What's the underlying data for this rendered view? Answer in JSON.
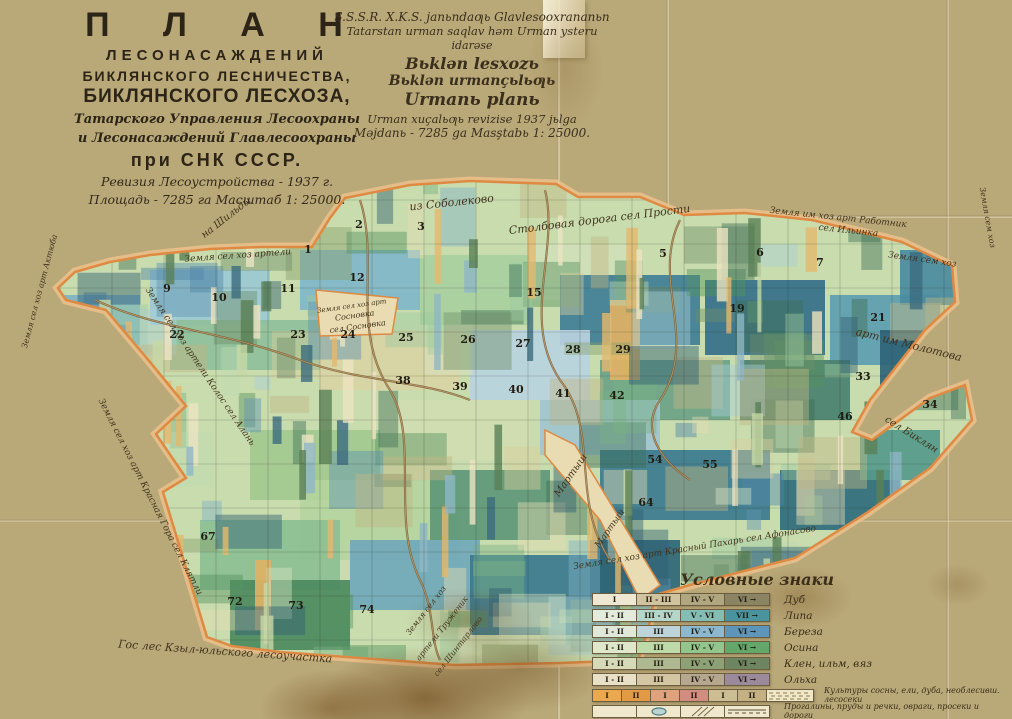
{
  "title_block": {
    "lines": [
      "П Л А Н",
      "ЛЕСОНАСАЖДЕНИЙ",
      "БИКЛЯНСКОГО  ЛЕСНИЧЕСТВА,",
      "БИКЛЯНСКОГО ЛЕСХОЗА,",
      "Татарского Управления Лесоохраны",
      "и Лесонасаждений Главлесоохраны",
      "при  СНК  СССР.",
      "Ревизия Лесоустройства - 1937 г.",
      "Площадь - 7285 га  Масштаб 1: 25000."
    ]
  },
  "tatar_block": {
    "lines": [
      "S.S.S.R. X.K.S. janьndaƣь Glavlesooxrananьn",
      "Tatarstan urman saqlav həm Urman ysteru",
      "idarəse",
      "Bьklən lesxozь",
      "Bьklən urmançьlьƣь",
      "Urmanь planь",
      "Urman xuçalьƣь revizise 1937 jьlga",
      "Məjdanь - 7285 ga  Masştabь 1: 25000."
    ]
  },
  "legend": {
    "title": "Условные знаки",
    "rows": [
      {
        "label": "Дуб",
        "cells": [
          {
            "t": "I",
            "c": "#eee7d2"
          },
          {
            "t": "II - III",
            "c": "#cfc49f"
          },
          {
            "t": "IV - V",
            "c": "#b0a67f"
          },
          {
            "t": "VI →",
            "c": "#8b8462"
          }
        ]
      },
      {
        "label": "Липа",
        "cells": [
          {
            "t": "I - II",
            "c": "#e3ecdc"
          },
          {
            "t": "III - IV",
            "c": "#b5d6ca"
          },
          {
            "t": "V - VI",
            "c": "#83bdb4"
          },
          {
            "t": "VII →",
            "c": "#49949e"
          }
        ]
      },
      {
        "label": "Береза",
        "cells": [
          {
            "t": "I - II",
            "c": "#e0e8da"
          },
          {
            "t": "III",
            "c": "#bcd4da"
          },
          {
            "t": "IV - V",
            "c": "#8cb9cf"
          },
          {
            "t": "VI →",
            "c": "#5d95bb"
          }
        ]
      },
      {
        "label": "Осина",
        "cells": [
          {
            "t": "I - II",
            "c": "#dfe8ca"
          },
          {
            "t": "III",
            "c": "#bedaa8"
          },
          {
            "t": "IV - V",
            "c": "#93c68c"
          },
          {
            "t": "VI →",
            "c": "#63a76b"
          }
        ]
      },
      {
        "label": "Клен, ильм, вяз",
        "cells": [
          {
            "t": "I - II",
            "c": "#d6dab9"
          },
          {
            "t": "III",
            "c": "#aeb991"
          },
          {
            "t": "IV - V",
            "c": "#8da177"
          },
          {
            "t": "VI →",
            "c": "#6d8561"
          }
        ]
      },
      {
        "label": "Ольха",
        "cells": [
          {
            "t": "I - II",
            "c": "#e9e0c8"
          },
          {
            "t": "III",
            "c": "#d4c6a3"
          },
          {
            "t": "IV - V",
            "c": "#b6a890"
          },
          {
            "t": "VI →",
            "c": "#9a8a9b"
          }
        ]
      }
    ],
    "row7": {
      "cells": [
        {
          "t": "I",
          "c": "#eaa94e"
        },
        {
          "t": "II",
          "c": "#e39a45"
        },
        {
          "t": "I",
          "c": "#dfa27c"
        },
        {
          "t": "II",
          "c": "#d28d80"
        },
        {
          "t": "I",
          "c": "#cdbd92"
        },
        {
          "t": "II",
          "c": "#c3b184"
        }
      ],
      "dashed_color": "#efe7c6",
      "label": "Культуры сосны, ели, дуба, необлесивш. лесосеки"
    },
    "row8": {
      "symbols": [
        "blank",
        "pond",
        "ravine",
        "road"
      ],
      "label": "Прогалины, пруды и речки, овраги, просеки и дороги"
    }
  },
  "map": {
    "paper": "#e9dcb2",
    "border_outer": "#f0c28c",
    "border_inner": "#de8a43",
    "base": "#c9dcae",
    "outline": [
      [
        58,
        288
      ],
      [
        75,
        272
      ],
      [
        110,
        262
      ],
      [
        150,
        255
      ],
      [
        210,
        249
      ],
      [
        262,
        247
      ],
      [
        312,
        247
      ],
      [
        330,
        218
      ],
      [
        345,
        198
      ],
      [
        410,
        185
      ],
      [
        470,
        181
      ],
      [
        556,
        184
      ],
      [
        578,
        197
      ],
      [
        640,
        197
      ],
      [
        684,
        215
      ],
      [
        745,
        213
      ],
      [
        812,
        220
      ],
      [
        902,
        242
      ],
      [
        952,
        266
      ],
      [
        955,
        302
      ],
      [
        925,
        330
      ],
      [
        870,
        400
      ],
      [
        852,
        432
      ],
      [
        872,
        440
      ],
      [
        930,
        398
      ],
      [
        965,
        385
      ],
      [
        972,
        420
      ],
      [
        930,
        468
      ],
      [
        868,
        512
      ],
      [
        795,
        558
      ],
      [
        748,
        570
      ],
      [
        690,
        585
      ],
      [
        655,
        595
      ],
      [
        648,
        630
      ],
      [
        638,
        660
      ],
      [
        560,
        663
      ],
      [
        455,
        665
      ],
      [
        360,
        658
      ],
      [
        280,
        652
      ],
      [
        232,
        646
      ],
      [
        207,
        637
      ],
      [
        163,
        492
      ],
      [
        186,
        478
      ],
      [
        156,
        434
      ],
      [
        186,
        406
      ],
      [
        150,
        362
      ],
      [
        106,
        310
      ],
      [
        66,
        300
      ]
    ],
    "blocks": [
      [
        300,
        250,
        120,
        60,
        "#7fb6c8"
      ],
      [
        420,
        255,
        110,
        70,
        "#a9cf9f"
      ],
      [
        530,
        245,
        100,
        55,
        "#cfe0b8"
      ],
      [
        560,
        275,
        140,
        70,
        "#3f7e95"
      ],
      [
        705,
        280,
        120,
        75,
        "#356f88"
      ],
      [
        830,
        295,
        110,
        70,
        "#5d9db0"
      ],
      [
        880,
        330,
        70,
        60,
        "#2f6478"
      ],
      [
        150,
        270,
        120,
        55,
        "#9ac8d2"
      ],
      [
        60,
        295,
        80,
        50,
        "#7fb2c4"
      ],
      [
        170,
        320,
        150,
        50,
        "#8fbf9a"
      ],
      [
        320,
        330,
        140,
        60,
        "#d8d2a4"
      ],
      [
        470,
        330,
        120,
        70,
        "#b9d3e0"
      ],
      [
        600,
        360,
        130,
        60,
        "#6ca287"
      ],
      [
        740,
        360,
        110,
        60,
        "#49806f"
      ],
      [
        380,
        400,
        150,
        60,
        "#cfdcb0"
      ],
      [
        540,
        400,
        120,
        55,
        "#9fc4ce"
      ],
      [
        250,
        430,
        130,
        70,
        "#a3c98f"
      ],
      [
        600,
        450,
        170,
        70,
        "#3b7a8e"
      ],
      [
        780,
        470,
        120,
        60,
        "#2f6b7c"
      ],
      [
        860,
        430,
        80,
        50,
        "#559a8a"
      ],
      [
        300,
        480,
        160,
        80,
        "#b4d49e"
      ],
      [
        430,
        470,
        120,
        70,
        "#5e9778"
      ],
      [
        200,
        520,
        140,
        70,
        "#8cbf92"
      ],
      [
        350,
        540,
        130,
        70,
        "#70a8b8"
      ],
      [
        470,
        555,
        150,
        80,
        "#39788e"
      ],
      [
        590,
        540,
        90,
        60,
        "#2e6577"
      ],
      [
        230,
        580,
        120,
        70,
        "#4c8a60"
      ],
      [
        900,
        250,
        55,
        55,
        "#4a8ba0"
      ],
      [
        610,
        300,
        30,
        80,
        "#e0b264"
      ],
      [
        255,
        560,
        16,
        70,
        "#e0b264"
      ]
    ],
    "palette": [
      "#7fb2c8",
      "#5d93b4",
      "#a8cfd8",
      "#4f86a8",
      "#9ec9a0",
      "#79b283",
      "#57935f",
      "#bcd9b2",
      "#e4dcb4",
      "#d9cf9e",
      "#c2b583",
      "#6e8f6a",
      "#3f6f57",
      "#8aa06c",
      "#d6e4c2",
      "#2f5d70"
    ],
    "strip_palette": [
      "#ece4c2",
      "#e3b96e",
      "#5a7f55",
      "#8fb7c6",
      "#c7d8a6",
      "#3b6b7e"
    ],
    "corridors": [
      [
        [
          545,
          430
        ],
        [
          575,
          445
        ],
        [
          660,
          585
        ],
        [
          640,
          600
        ],
        [
          600,
          520
        ],
        [
          545,
          455
        ]
      ],
      [
        [
          316,
          290
        ],
        [
          398,
          298
        ],
        [
          392,
          334
        ],
        [
          320,
          336
        ]
      ]
    ],
    "roads": [
      "M 360,200 C 380,260 350,330 390,390 C 420,440 390,520 420,580 C 435,610 430,640 440,660",
      "M 545,190 C 560,250 520,320 560,380 C 600,430 570,500 610,560",
      "M 680,220 C 650,280 700,340 660,400 C 640,430 660,460 690,480",
      "M 95,300 C 160,330 220,330 300,360 C 360,382 420,380 470,400"
    ],
    "quarters": [
      [
        "1",
        308,
        253
      ],
      [
        "2",
        359,
        228
      ],
      [
        "3",
        421,
        230
      ],
      [
        "5",
        663,
        257
      ],
      [
        "6",
        760,
        256
      ],
      [
        "7",
        820,
        266
      ],
      [
        "9",
        167,
        292
      ],
      [
        "10",
        219,
        301
      ],
      [
        "11",
        288,
        292
      ],
      [
        "12",
        357,
        281
      ],
      [
        "15",
        534,
        296
      ],
      [
        "19",
        737,
        312
      ],
      [
        "21",
        878,
        321
      ],
      [
        "22",
        177,
        338
      ],
      [
        "23",
        298,
        338
      ],
      [
        "24",
        348,
        338
      ],
      [
        "25",
        406,
        341
      ],
      [
        "26",
        468,
        343
      ],
      [
        "27",
        523,
        347
      ],
      [
        "28",
        573,
        353
      ],
      [
        "29",
        623,
        353
      ],
      [
        "33",
        863,
        380
      ],
      [
        "34",
        930,
        408
      ],
      [
        "38",
        403,
        384
      ],
      [
        "39",
        460,
        390
      ],
      [
        "40",
        516,
        393
      ],
      [
        "41",
        563,
        397
      ],
      [
        "42",
        617,
        399
      ],
      [
        "46",
        845,
        420
      ],
      [
        "54",
        655,
        463
      ],
      [
        "55",
        710,
        468
      ],
      [
        "64",
        646,
        506
      ],
      [
        "67",
        208,
        540
      ],
      [
        "72",
        235,
        605
      ],
      [
        "73",
        296,
        609
      ],
      [
        "74",
        367,
        613
      ]
    ],
    "labels": [
      {
        "text": "на Шильды",
        "x": 228,
        "y": 220,
        "r": -38,
        "s": 10
      },
      {
        "text": "из Соболеково",
        "x": 452,
        "y": 206,
        "r": -6,
        "s": 11
      },
      {
        "text": "Земля сел хоз артели",
        "x": 238,
        "y": 258,
        "r": -4,
        "s": 9
      },
      {
        "text": "Столбовая дорога сел Прости",
        "x": 600,
        "y": 223,
        "r": -7,
        "s": 11
      },
      {
        "text": "Земля им хоз арт Работник",
        "x": 838,
        "y": 220,
        "r": 6,
        "s": 9
      },
      {
        "text": "сел Ильинка",
        "x": 848,
        "y": 233,
        "r": 6,
        "s": 9
      },
      {
        "text": "Земля сем хоз",
        "x": 922,
        "y": 262,
        "r": 8,
        "s": 9
      },
      {
        "text": "арт им Молотова",
        "x": 908,
        "y": 348,
        "r": 14,
        "s": 11
      },
      {
        "text": "сел Биклян",
        "x": 910,
        "y": 437,
        "r": 32,
        "s": 10
      },
      {
        "text": "Мартыш",
        "x": 573,
        "y": 477,
        "r": -55,
        "s": 10
      },
      {
        "text": "Мартыш",
        "x": 612,
        "y": 530,
        "r": -55,
        "s": 9
      },
      {
        "text": "Земля сел хоз арт",
        "x": 352,
        "y": 308,
        "r": -8,
        "s": 7
      },
      {
        "text": "Сосновка",
        "x": 355,
        "y": 318,
        "r": -8,
        "s": 8
      },
      {
        "text": "сел Сосновка",
        "x": 358,
        "y": 329,
        "r": -8,
        "s": 8
      },
      {
        "text": "Земля сел хоз артели Колос сел Алань",
        "x": 198,
        "y": 368,
        "r": 56,
        "s": 9
      },
      {
        "text": "Земля сел хоз арт Красная Гора сел Клятли",
        "x": 148,
        "y": 498,
        "r": 63,
        "s": 9
      },
      {
        "text": "Земля сел хоз арт Актюба",
        "x": 42,
        "y": 292,
        "r": -75,
        "s": 8
      },
      {
        "text": "Гос лес   Кзыл-юльского лесоучастка",
        "x": 225,
        "y": 655,
        "r": 4,
        "s": 11
      },
      {
        "text": "Земля сел хоз",
        "x": 428,
        "y": 612,
        "r": -52,
        "s": 8
      },
      {
        "text": "артели Труженик",
        "x": 444,
        "y": 630,
        "r": -52,
        "s": 8
      },
      {
        "text": "сел Шинтарлово",
        "x": 460,
        "y": 648,
        "r": -52,
        "s": 8
      },
      {
        "text": "Земля сел хоз арт  Красный Пахарь сел Афонасово",
        "x": 695,
        "y": 550,
        "r": -9,
        "s": 9
      },
      {
        "text": "Земля сем хоз",
        "x": 985,
        "y": 218,
        "r": 80,
        "s": 8
      }
    ]
  }
}
